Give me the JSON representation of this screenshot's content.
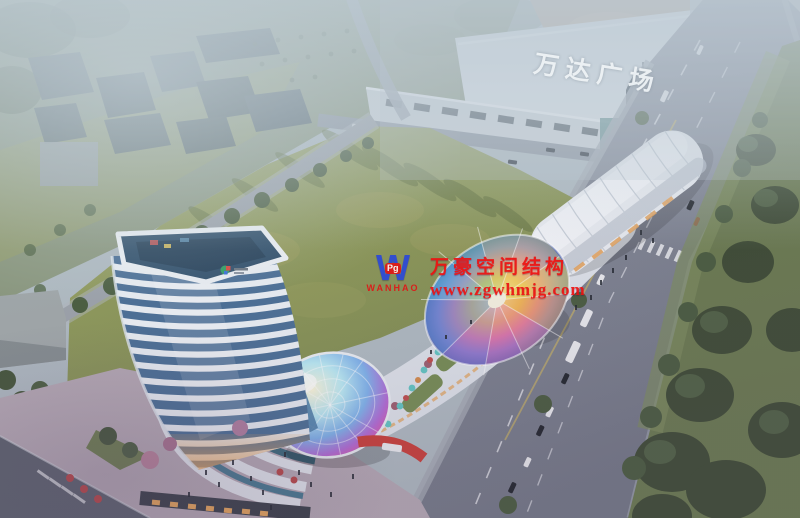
{
  "scene": {
    "type": "aerial-architectural-rendering",
    "mall": {
      "sign": "万达广场"
    },
    "watermark": {
      "logo_letter": "W",
      "logo_badge": "Pg",
      "logo_name": "WANHAO",
      "company": "万豪空间结构",
      "website": "www.zgwhmjg.com"
    },
    "colors": {
      "watermark_red": "#ed1111",
      "logo_blue": "#2b49d8",
      "mall_sign_white": "#edf2f5",
      "haze": "#bcc9d2",
      "lawn_green": "#93a05f",
      "road_gray": "#858a98",
      "tower_glass_blue": "#4c7096",
      "tower_band_white": "#e8edf2",
      "dome_iridescent": "#7fb2ea",
      "canopy_warm": "#f0c46a",
      "shop_glow_orange": "#e2a159"
    }
  }
}
